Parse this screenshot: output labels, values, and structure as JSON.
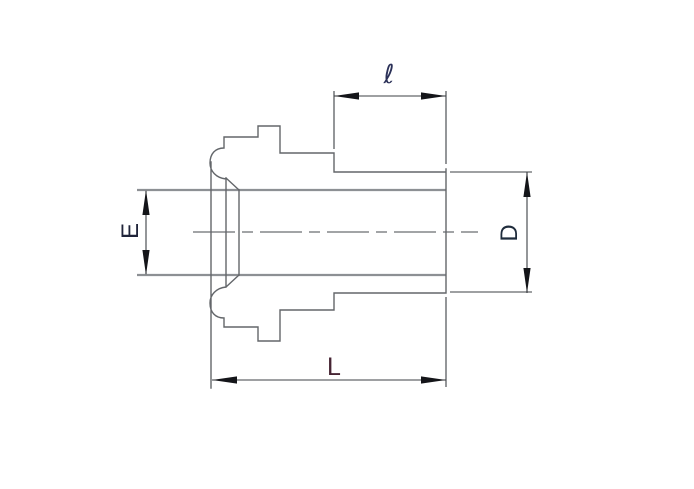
{
  "dimensions": {
    "l": {
      "label": "ℓ"
    },
    "E": {
      "label": "E"
    },
    "D": {
      "label": "D"
    },
    "L": {
      "label": "L"
    }
  },
  "colors": {
    "background": "#ffffff",
    "outline": "#63666a",
    "tube": "#8d9094",
    "centerline": "#45484d",
    "dim": "#3d4045",
    "arrow": "#141519",
    "label_ell": "#2b3158",
    "label_e": "#20243a",
    "label_d": "#1f2c3c",
    "label_big_l": "#462433"
  }
}
